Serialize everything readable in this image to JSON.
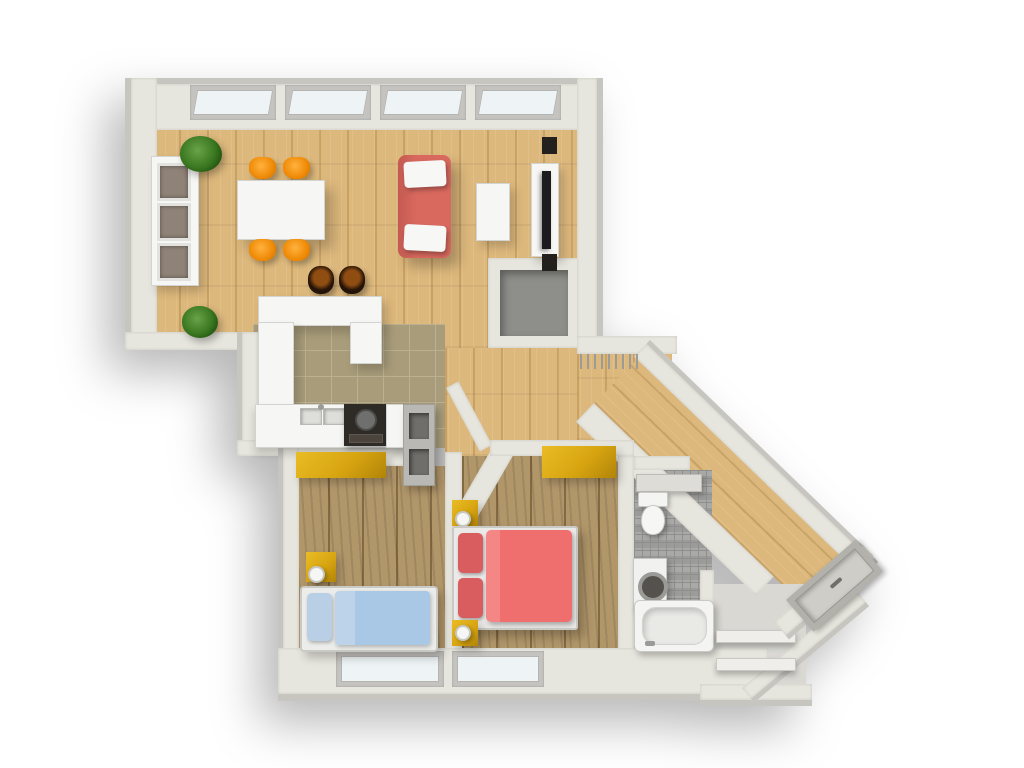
{
  "scene": {
    "title": "3D top-down floor plan render of a one-bedroom apartment with kids room",
    "view": "bird's-eye 3D architectural rendering",
    "background": "#ffffff"
  },
  "colors": {
    "wall_face": "#e7e6de",
    "wall_outer": "#c6c5c0",
    "wall_edge": "#a9a8a3",
    "wood_light": "#ddb87c",
    "wood_dark": "#b1966a",
    "tile_kitchen": "#a89c7a",
    "tile_kitchen_grout": "#bab092",
    "tile_bath": "#a3a3a1",
    "tile_bath_grout": "#8f8f8d",
    "closet_floor": "#8e8e8a",
    "storage_floor": "#d9d8d3",
    "furniture_white": "#f6f6f4",
    "appliance_dark": "#2e2a26",
    "accent_yellow": "#d8a511",
    "accent_orange": "#ef8a06",
    "sofa_red": "#d9695f",
    "bed_red": "#ee6f6d",
    "pillow_red": "#d95c5e",
    "bed_blue": "#a9c8e5",
    "pillow_blue": "#b9cfe6",
    "plant_green": "#38761f",
    "window_glass": "#eef3f5",
    "door_gray": "#cfcdc7",
    "tv_black": "#1c1c1e",
    "stool_brown": "#8f4d12",
    "stool_dark": "#241307",
    "shadow": "rgba(0,0,0,0.28)"
  },
  "rooms": [
    {
      "id": "living-dining",
      "label": "Living / dining room",
      "floor": "light wood planks",
      "windows": 4
    },
    {
      "id": "kitchen",
      "label": "Open kitchen",
      "floor": "olive ceramic tile",
      "windows": 0
    },
    {
      "id": "hallway",
      "label": "Diagonal entrance hallway",
      "floor": "light wood planks",
      "windows": 0
    },
    {
      "id": "closet",
      "label": "Storage alcove off living room",
      "floor": "gray screed",
      "windows": 0
    },
    {
      "id": "kids-room",
      "label": "Kids bedroom",
      "floor": "rustic wood planks",
      "windows": 1
    },
    {
      "id": "master-bedroom",
      "label": "Master bedroom",
      "floor": "rustic wood planks",
      "windows": 1
    },
    {
      "id": "bathroom",
      "label": "Bathroom",
      "floor": "gray mosaic tile",
      "windows": 0
    },
    {
      "id": "storage-nook",
      "label": "Corner storage nook with shelves",
      "floor": "gray screed",
      "windows": 0
    }
  ],
  "furniture": {
    "living_dining": [
      "white display cabinet with 3 glass panels",
      "potted plant x2",
      "white dining table",
      "orange dining chair x4",
      "bar stool x2",
      "red sofa with 2 white cushions",
      "white coffee table",
      "TV media cabinet with flat TV and 2 speakers"
    ],
    "kitchen": [
      "white peninsula counter (U-shape)",
      "white base cabinets",
      "double sink",
      "dark cooktop with oven",
      "open shelf unit"
    ],
    "kids_room": [
      "yellow wardrobe",
      "yellow nightstand with white lamp",
      "single bed with blue duvet and pillow"
    ],
    "master_bedroom": [
      "yellow wardrobe",
      "yellow nightstand with white lamp x2",
      "double bed with red duvet and 2 red pillows"
    ],
    "bathroom": [
      "wall shelf",
      "toilet",
      "washing machine",
      "bathtub"
    ],
    "hallway": [
      "wall radiator",
      "entrance door"
    ],
    "storage_nook": [
      "shelf board x2"
    ]
  }
}
